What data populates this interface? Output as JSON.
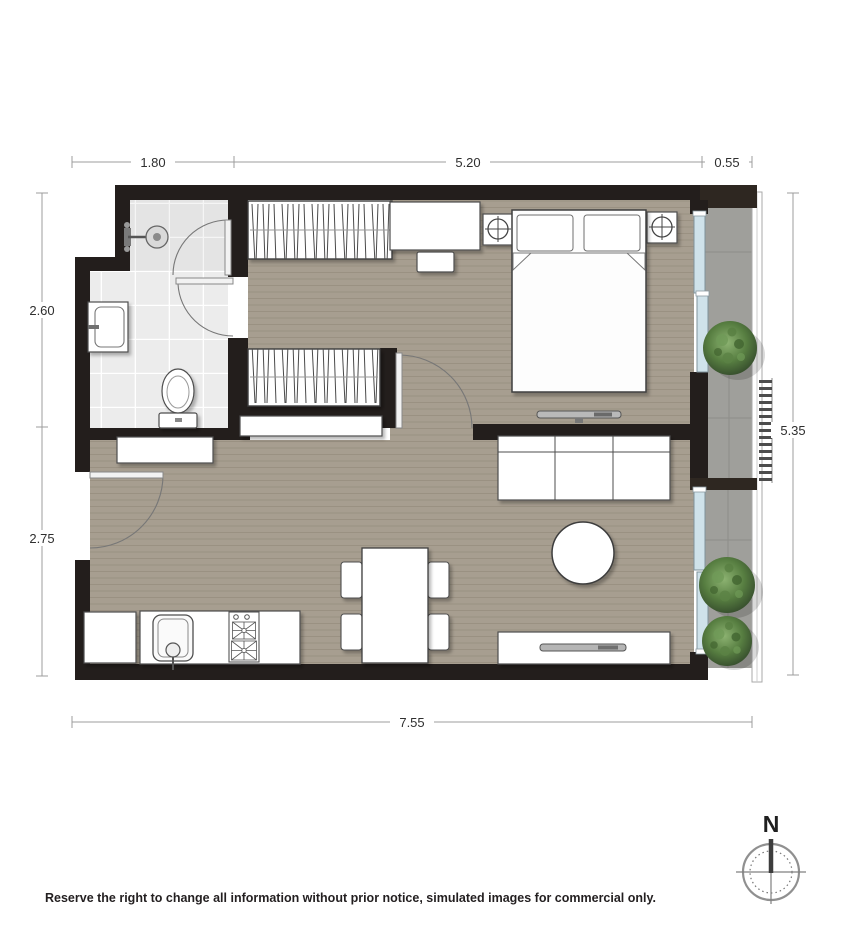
{
  "plan": {
    "dimensions": {
      "top": [
        "1.80",
        "5.20",
        "0.55"
      ],
      "left": [
        "2.60",
        "2.75"
      ],
      "right": [
        "5.35"
      ],
      "bottom": [
        "7.55"
      ]
    },
    "compass": {
      "north": "N"
    },
    "disclaimer": "Reserve the right to change all information without prior notice, simulated images for commercial only.",
    "colors": {
      "wall": "#231e1c",
      "wood_floor": "#a79e90",
      "bath_tile": "#ececec",
      "balcony_tile": "#9f9f9b",
      "glass_door": "#cfe2ea",
      "plant_green": "#4a6e38",
      "dim_line": "#9c9c9c"
    }
  }
}
